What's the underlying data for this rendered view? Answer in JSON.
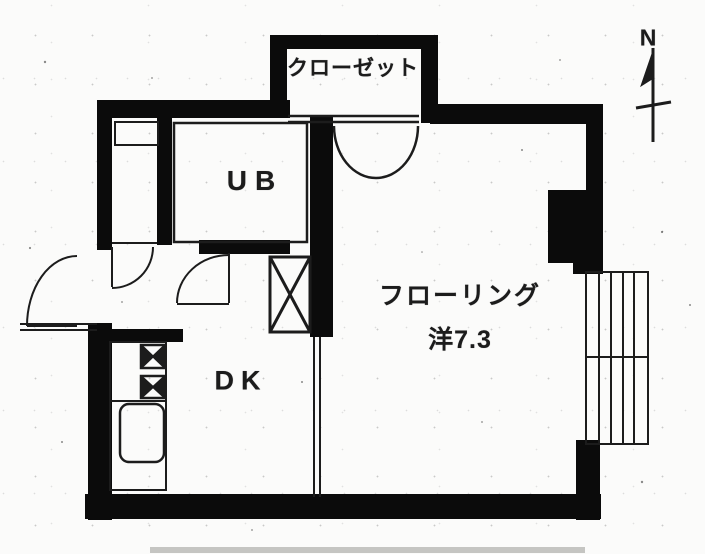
{
  "floor_plan": {
    "rooms": {
      "closet_label": "クローゼット",
      "unit_bath_label": "UB",
      "dining_kitchen_label": "DK",
      "living_label_line1": "フローリング",
      "living_label_line2": "洋7.3"
    },
    "compass": {
      "north_label": "N"
    },
    "fixtures": {
      "ps_duct": "x-box-duct",
      "stove": "two-burner-stove",
      "sink": "kitchen-sink",
      "balcony": "hatched-balcony"
    },
    "colors": {
      "wall": "#0b0b0b",
      "line": "#1c1c1c",
      "paper": "#fbfbfa",
      "faint": "#c5c5c2"
    }
  }
}
